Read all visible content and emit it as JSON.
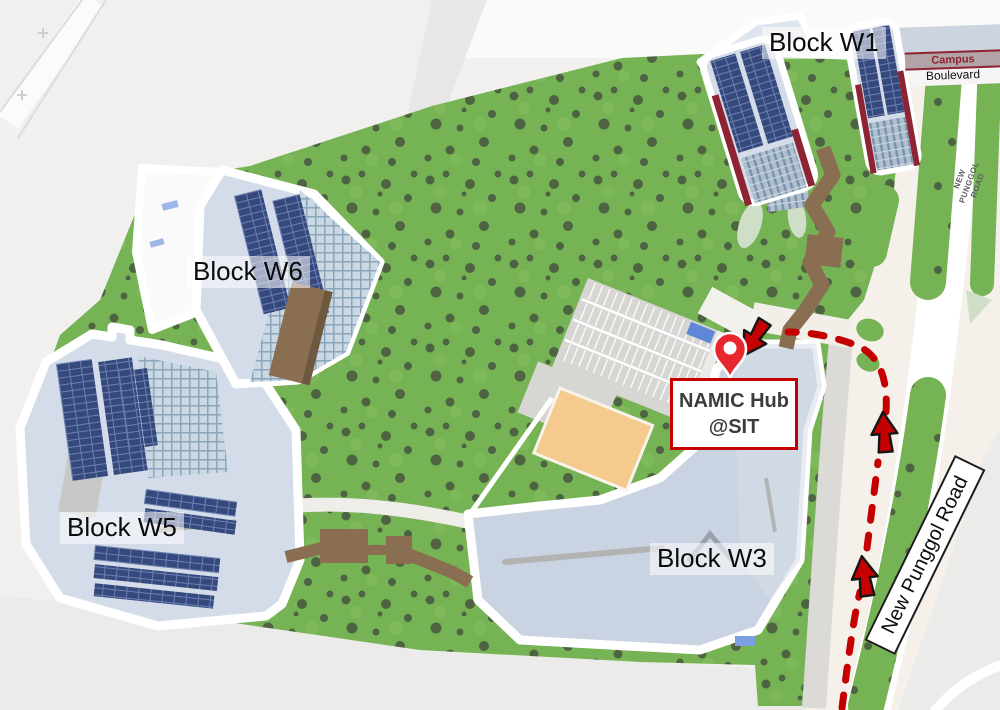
{
  "map": {
    "block_labels": [
      {
        "id": "w1",
        "label": "Block W1"
      },
      {
        "id": "w6",
        "label": "Block W6"
      },
      {
        "id": "w5",
        "label": "Block W5"
      },
      {
        "id": "w3",
        "label": "Block W3"
      }
    ],
    "destination_callout": {
      "line1": "NAMIC Hub",
      "line2": "@SIT"
    },
    "road_labels": {
      "new_punggol_road": "New Punggol Road",
      "new_punggol_road_small": "NEW PUNGGOL ROAD",
      "campus_boulevard_line1": "Campus",
      "campus_boulevard_line2": "Boulevard"
    },
    "icons": {
      "location_pin": "location-pin-icon",
      "route_arrow": "route-arrow-icon"
    },
    "colors": {
      "route": "#c40000",
      "pin": "#e8262e",
      "grass": "#76b354",
      "tree": "#47553d",
      "pale": "#cfdec6",
      "roof": "#d3dce8",
      "roof2": "#c9d3e1",
      "walkway": "#8a6e52",
      "court": "#f4ca8d",
      "maroon": "#8e2433",
      "callout_border": "#c40000",
      "callout_text": "#3c3c3c"
    }
  }
}
